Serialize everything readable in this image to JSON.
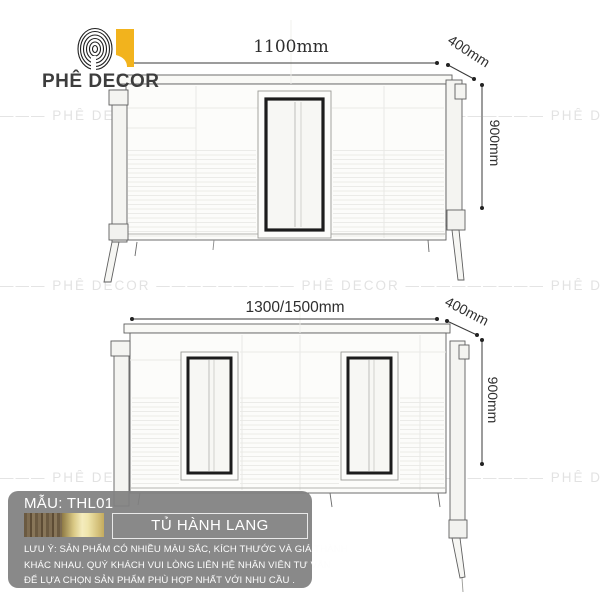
{
  "brand": {
    "name": "PHÊ DECOR",
    "logo_yellow": "#f2b31d"
  },
  "watermark": {
    "row": "———  PHÊ DECOR  —————————  PHÊ DECOR  —————————  PHÊ DECOR  ———"
  },
  "top_view": {
    "width": "1100mm",
    "depth": "400mm",
    "height": "900mm"
  },
  "bottom_view": {
    "width": "1300/1500mm",
    "depth": "400mm",
    "height": "900mm"
  },
  "panel": {
    "model": "MẪU: THL01",
    "product": "TỦ HÀNH LANG",
    "notes": [
      "LƯU Ý: SẢN PHẨM CÓ NHIỀU MÀU SẮC, KÍCH THƯỚC VÀ GIÁ THÀNH",
      "KHÁC NHAU. QUÝ KHÁCH VUI LÒNG LIÊN HỆ NHÂN VIÊN TƯ VẤN",
      "ĐỂ LỰA CHỌN SẢN PHẨM PHÙ HỢP NHẤT VỚI NHU CẦU ."
    ],
    "swatches": [
      {
        "name": "wood",
        "color": "#6b5a41"
      },
      {
        "name": "gold",
        "color": "#d9c884"
      }
    ],
    "colors": {
      "panel_bg": "#808080",
      "text": "#ffffff"
    }
  }
}
